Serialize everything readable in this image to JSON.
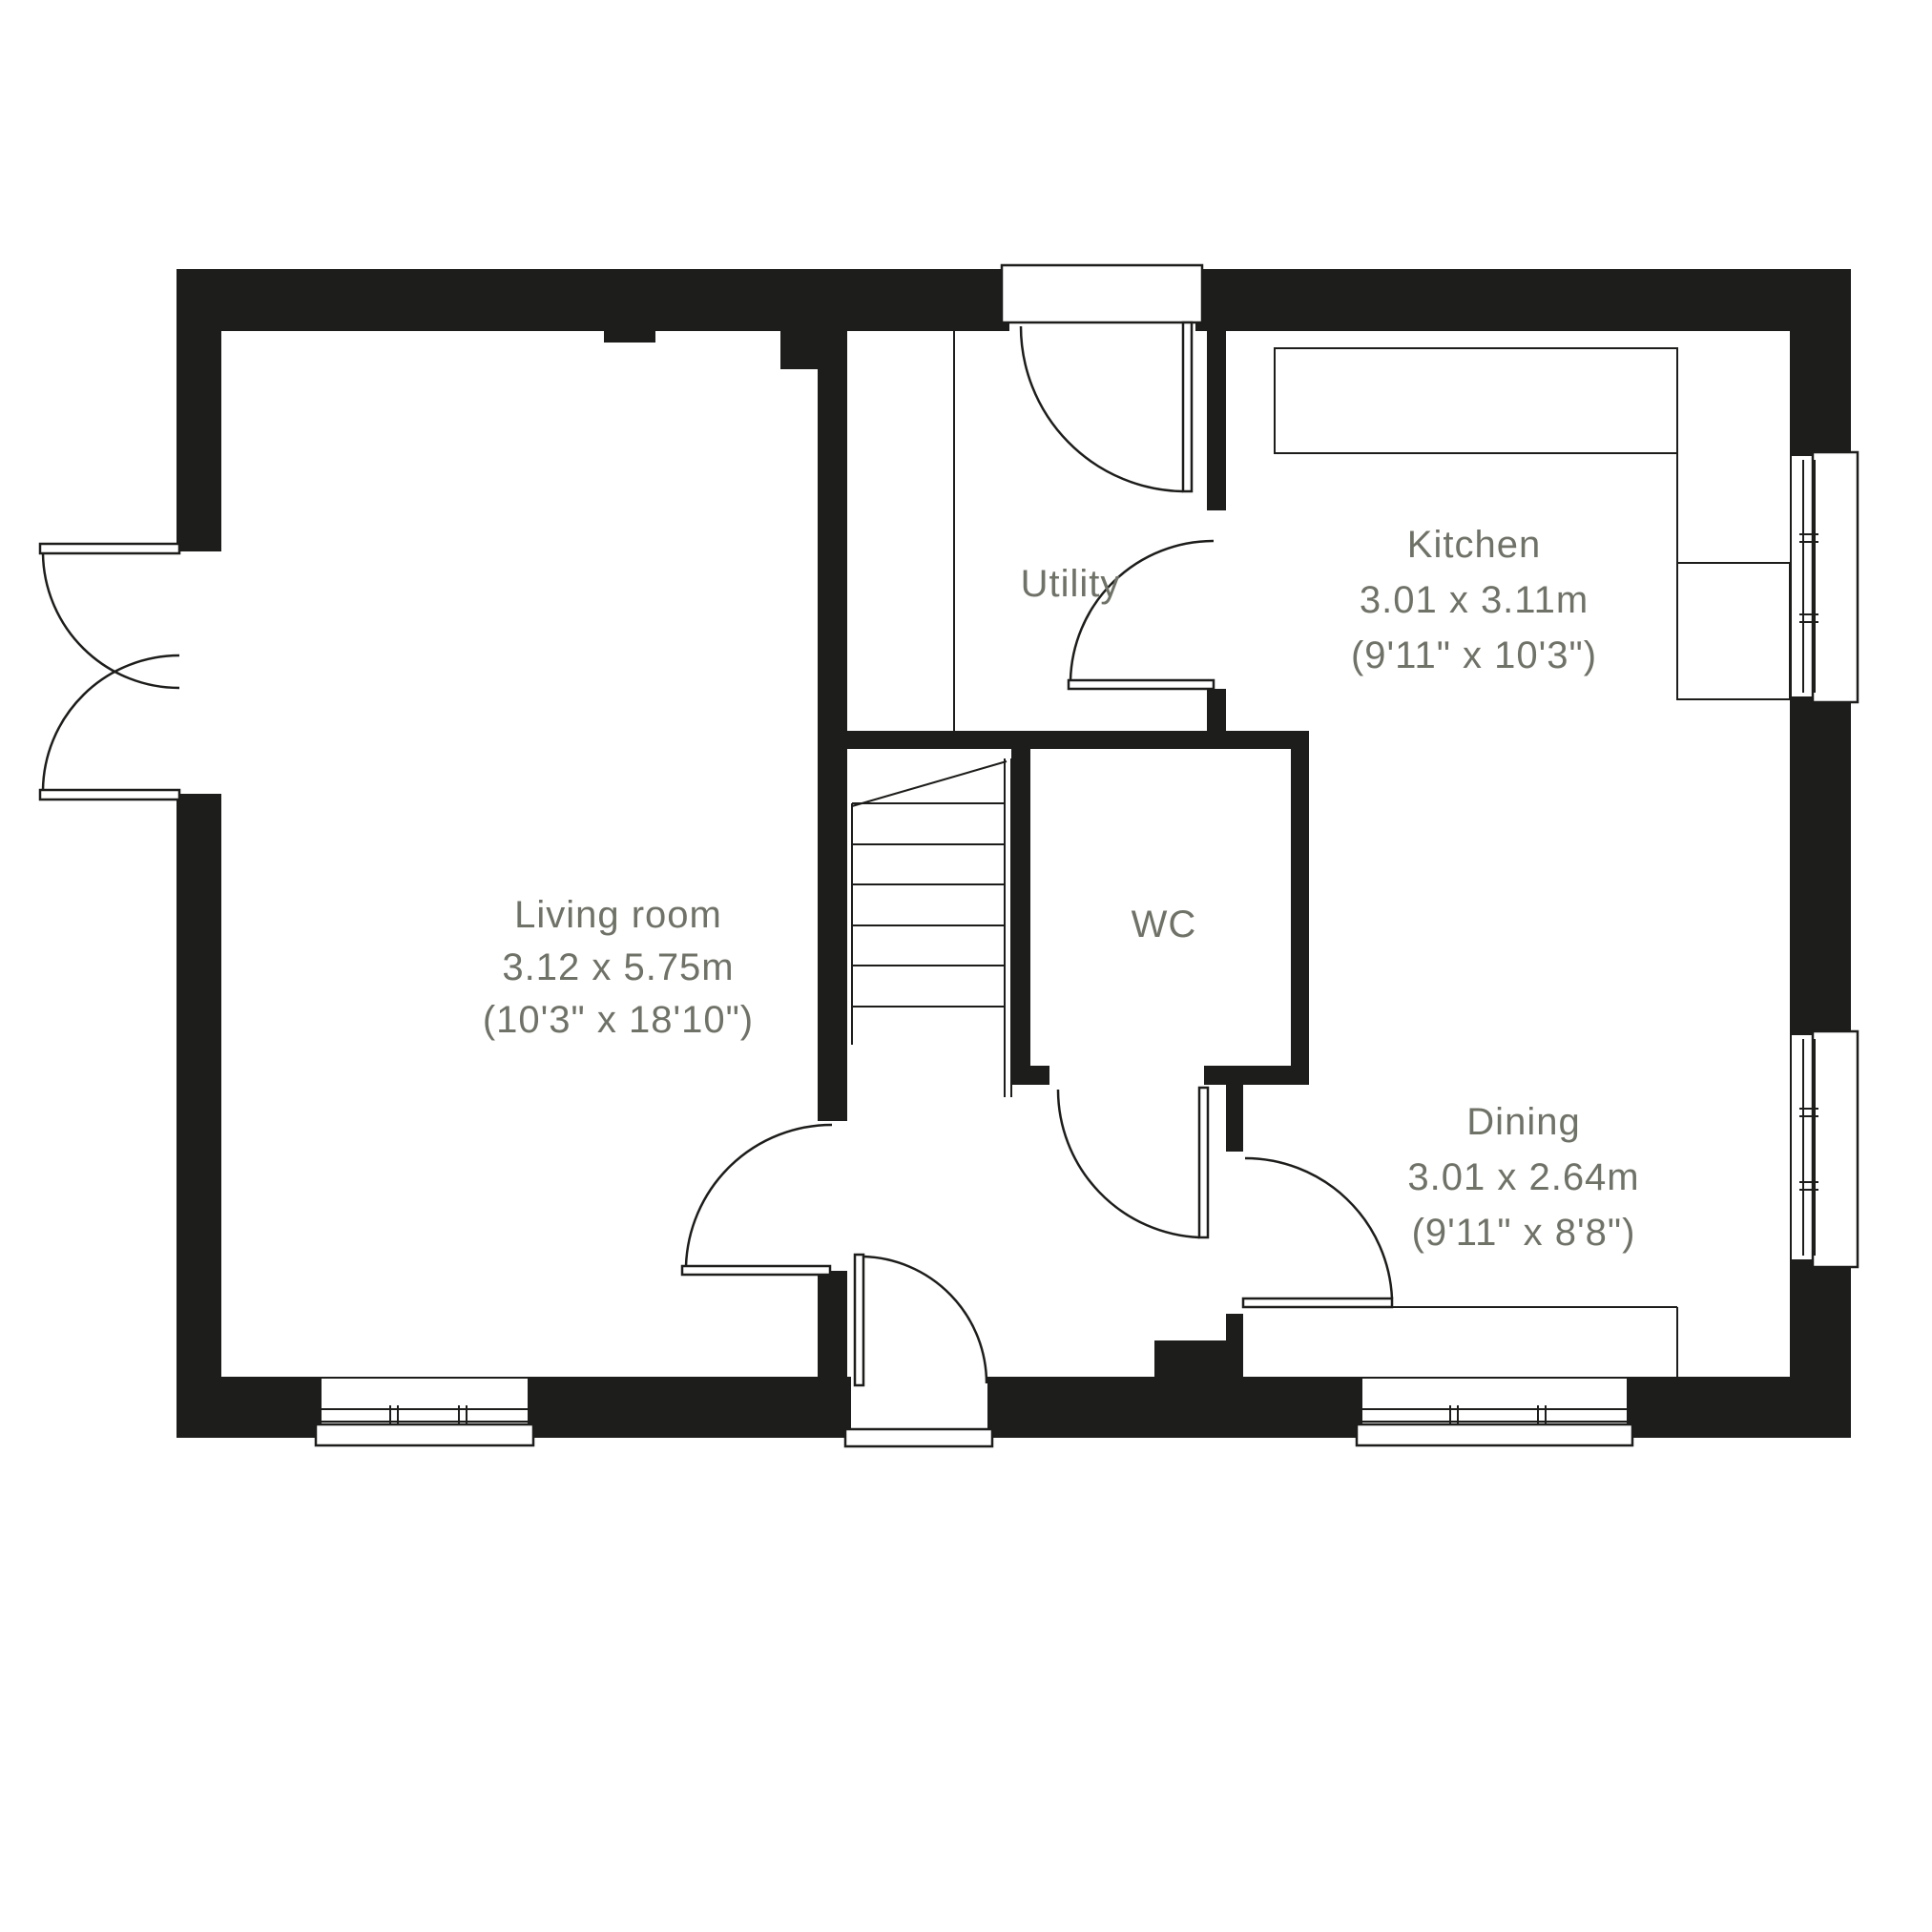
{
  "floorplan": {
    "rooms": [
      {
        "id": "living",
        "name": "Living room",
        "dims_metric": "3.12 x 5.75m",
        "dims_imperial": "(10'3\" x 18'10\")"
      },
      {
        "id": "utility",
        "name": "Utility",
        "dims_metric": "",
        "dims_imperial": ""
      },
      {
        "id": "kitchen",
        "name": "Kitchen",
        "dims_metric": "3.01 x 3.11m",
        "dims_imperial": "(9'11\" x 10'3\")"
      },
      {
        "id": "wc",
        "name": "WC",
        "dims_metric": "",
        "dims_imperial": ""
      },
      {
        "id": "dining",
        "name": "Dining",
        "dims_metric": "3.01 x 2.64m",
        "dims_imperial": "(9'11\" x 8'8\")"
      }
    ],
    "colors": {
      "wall": "#1d1d1b",
      "label": "#6f7267",
      "background": "#ffffff"
    }
  }
}
